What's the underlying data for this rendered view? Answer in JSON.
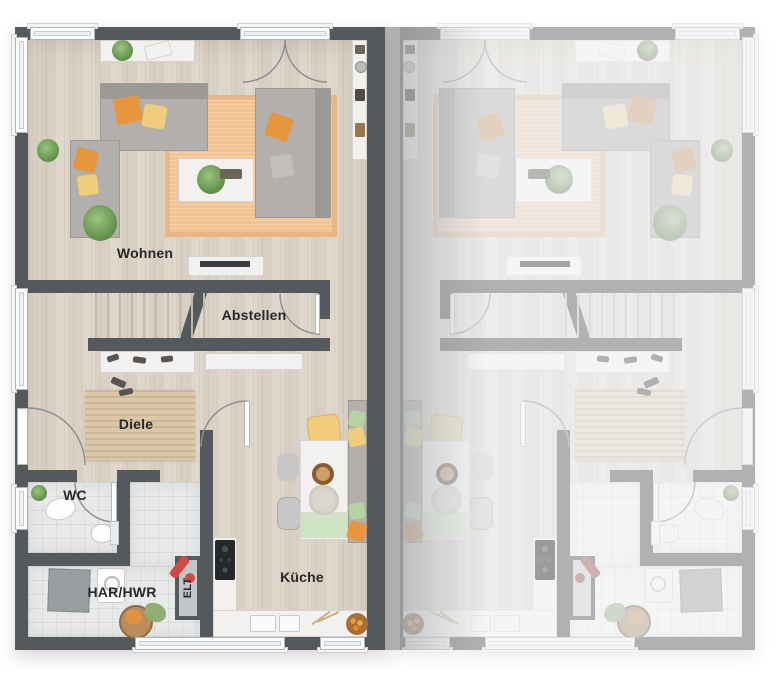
{
  "plan": {
    "title": "Doppelhaus Erdgeschoss Grundriss",
    "rooms": {
      "wohnen": {
        "label": "Wohnen"
      },
      "abstellen": {
        "label": "Abstellen"
      },
      "diele": {
        "label": "Diele"
      },
      "wc": {
        "label": "WC"
      },
      "har_hwr": {
        "label": "HAR/HWR"
      },
      "elt": {
        "label": "ELT"
      },
      "kueche": {
        "label": "Küche"
      }
    },
    "units": {
      "left": {
        "style": "active-color",
        "labels_visible": true
      },
      "right": {
        "style": "faded-mirror",
        "labels_visible": false
      }
    },
    "colors": {
      "wall": "#54595d",
      "wall_faded": "#9aa0a3",
      "floor_wood": "#d9cfc2",
      "floor_tile": "#e8e9e9",
      "rug_living": "#f3c393",
      "rug_hall": "#dbc8a9",
      "sofa_gray": "#b2afac",
      "accent_orange": "#e8963e",
      "accent_yellow": "#f0cd7c",
      "accent_green": "#b6d2a0",
      "vacuum_red": "#d04a43",
      "window_frame": "#fbfcfc"
    }
  }
}
